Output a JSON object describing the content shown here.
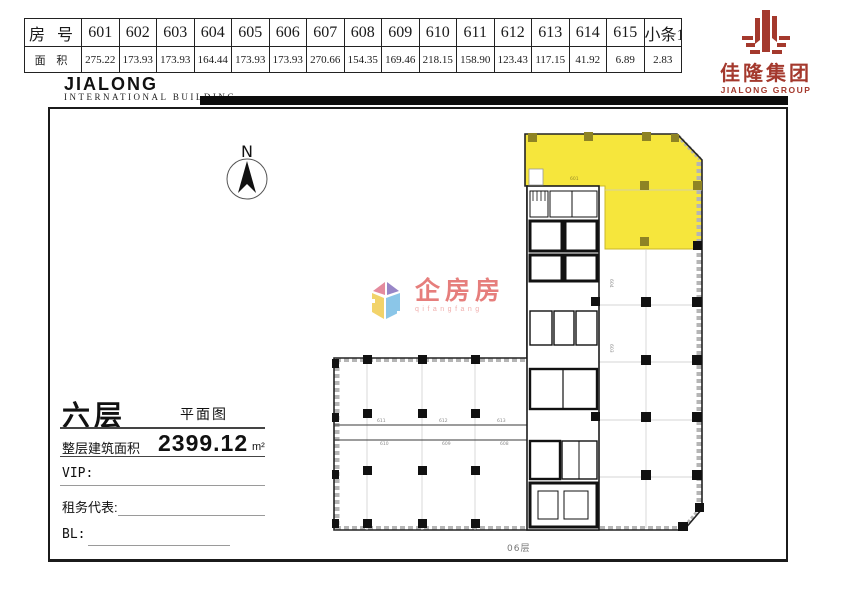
{
  "header_table": {
    "room_label": "房 号",
    "area_label": "面 积",
    "columns": [
      {
        "no": "601",
        "area": "275.22"
      },
      {
        "no": "602",
        "area": "173.93"
      },
      {
        "no": "603",
        "area": "173.93"
      },
      {
        "no": "604",
        "area": "164.44"
      },
      {
        "no": "605",
        "area": "173.93"
      },
      {
        "no": "606",
        "area": "173.93"
      },
      {
        "no": "607",
        "area": "270.66"
      },
      {
        "no": "608",
        "area": "154.35"
      },
      {
        "no": "609",
        "area": "169.46"
      },
      {
        "no": "610",
        "area": "218.15"
      },
      {
        "no": "611",
        "area": "158.90"
      },
      {
        "no": "612",
        "area": "123.43"
      },
      {
        "no": "613",
        "area": "117.15"
      },
      {
        "no": "614",
        "area": "41.92"
      },
      {
        "no": "615",
        "area": "6.89"
      },
      {
        "no": "小条1",
        "area": "2.83"
      }
    ]
  },
  "brand": {
    "building_en": "JIALONG",
    "building_sub": "INTERNATIONAL  BUILDING",
    "logo_cn": "佳隆集团",
    "logo_en": "JIALONG GROUP",
    "logo_color": "#a4392d"
  },
  "compass": {
    "label": "N"
  },
  "watermark": {
    "name_cn": "企房房",
    "name_py": "qifangfang",
    "text_color": "#e4716e"
  },
  "info_panel": {
    "floor": "六层",
    "plan_label": "平面图",
    "total_label": "整层建筑面积",
    "total_value": "2399.12",
    "total_unit": "m²",
    "vip_label": "VIP:",
    "agent_label": "租务代表:",
    "bl_label": "BL:"
  },
  "plan": {
    "floor_tag": "06层",
    "highlight_color": "#f6e63c",
    "highlight_label": "601",
    "corridor_labels_top": [
      "611",
      "612",
      "613"
    ],
    "corridor_labels_bottom": [
      "610",
      "609",
      "608"
    ],
    "vertical_labels": [
      "604",
      "603"
    ]
  }
}
